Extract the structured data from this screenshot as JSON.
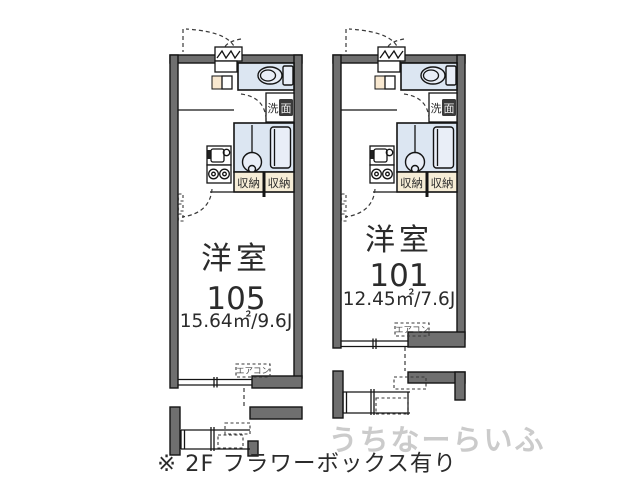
{
  "colors": {
    "wall": "#6f6f6f",
    "water": "#dce6f2",
    "fixture": "#e9eef7",
    "beige": "#f6edd7",
    "cream": "#f8e8d0",
    "ink": "#2b2b2b",
    "watermark": "#cbcbcb"
  },
  "units": [
    {
      "room_type": "洋室",
      "room_number": "105",
      "area": "15.64㎡/9.6J",
      "aircon_label": "エアコン"
    },
    {
      "room_type": "洋室",
      "room_number": "101",
      "area": "12.45㎡/7.6J",
      "aircon_label": "エアコン"
    }
  ],
  "fixtures": {
    "storage_left": "収納",
    "storage_right": "収納",
    "washroom_char1": "洗",
    "washroom_char2": "面"
  },
  "note": "※ 2F フラワーボックス有り",
  "watermark": "うちなーらいふ"
}
